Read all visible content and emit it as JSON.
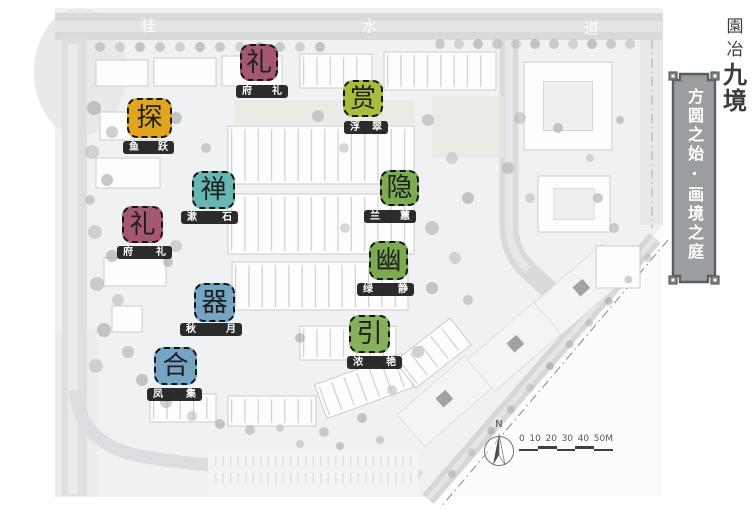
{
  "masterplan": {
    "road_labels": [
      "桂",
      "水",
      "道"
    ],
    "zones": [
      {
        "id": "li-north",
        "char": "礼",
        "color": "#a4576e",
        "label": "府礼"
      },
      {
        "id": "shang",
        "char": "赏",
        "color": "#a9bc3b",
        "label": "浮翠"
      },
      {
        "id": "tan",
        "char": "探",
        "color": "#e1a41f",
        "label": "鱼跃"
      },
      {
        "id": "chan",
        "char": "禅",
        "color": "#68b6b2",
        "label": "漱石"
      },
      {
        "id": "yin-hide",
        "char": "隐",
        "color": "#7cab51",
        "label": "兰蕙"
      },
      {
        "id": "li-west",
        "char": "礼",
        "color": "#a4576e",
        "label": "府礼"
      },
      {
        "id": "you",
        "char": "幽",
        "color": "#7cab51",
        "label": "绿静"
      },
      {
        "id": "qi",
        "char": "器",
        "color": "#76a4c4",
        "label": "秋月"
      },
      {
        "id": "yin-lead",
        "char": "引",
        "color": "#86b15b",
        "label": "浓艳"
      },
      {
        "id": "he",
        "char": "合",
        "color": "#76a4c4",
        "label": "凤集"
      }
    ],
    "compass": {
      "label": "N"
    },
    "scale_bar": {
      "labels": [
        "0",
        "10",
        "20",
        "30",
        "40",
        "50M"
      ]
    }
  },
  "sidebar": {
    "title": {
      "chars": [
        "園",
        "冶",
        "九",
        "境"
      ]
    },
    "banner": {
      "text": "方圆之始·画境之庭",
      "fill": "#9b9ea1",
      "border": "#5c5f61"
    }
  }
}
